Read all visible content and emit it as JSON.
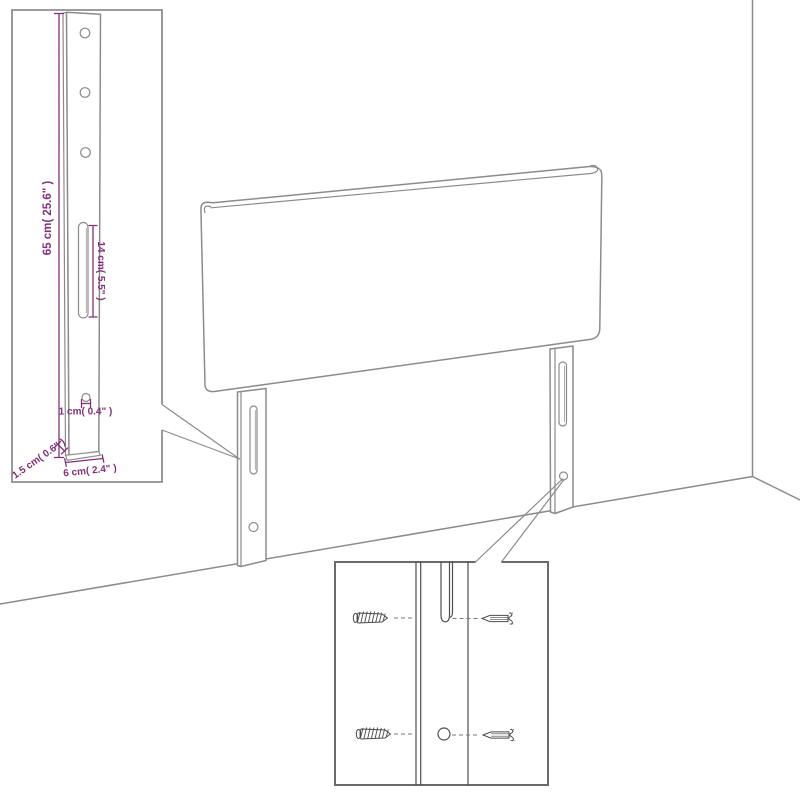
{
  "colors": {
    "background": "#ffffff",
    "outline": "#8b8b8b",
    "detail": "#4f4f4f",
    "dimension": "#82307c"
  },
  "insets": {
    "leg_detail": {
      "dims": {
        "height": "65 cm( 25.6\" )",
        "slot_length": "14 cm( 5.5\" )",
        "hole": "1 cm( 0.4\" )",
        "depth": "1.5 cm( 0.6\" )",
        "width": "6 cm( 2.4\" )"
      }
    },
    "screw_detail": {
      "screws_visible": 4,
      "holes_visible": 2
    }
  }
}
